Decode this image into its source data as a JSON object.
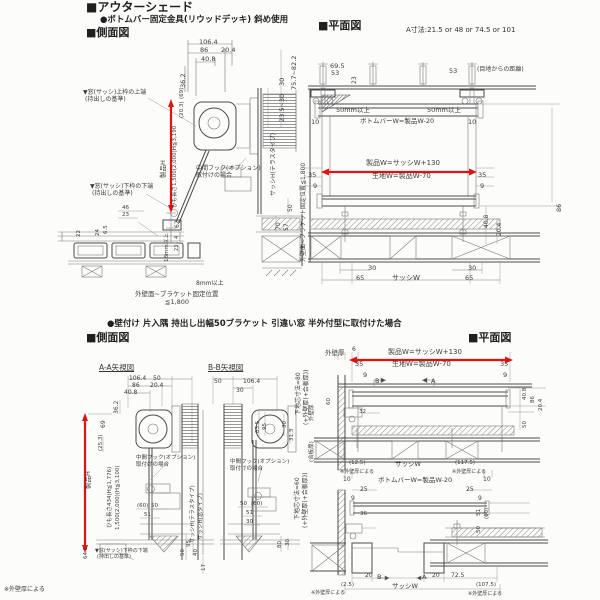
{
  "colors": {
    "accent_red": "#e01212",
    "line": "#7a7a7a",
    "dark_line": "#4c4c4c",
    "text": "#3b3b3b",
    "paper": "#fcfcfb"
  },
  "headers": {
    "title": "■アウターシェード",
    "subtitle": "●ボトムバー固定金具(リウッドデッキ) 斜め使用",
    "side_view_1": "■側面図",
    "plan_view_1": "■平面図",
    "a_dim_note": "A寸法:21.5 or 48 or 74.5 or 101",
    "subtitle_2": "●壁付け 片入隅 持出し出幅50ブラケット 引違い窓 半外付型に取付けた場合",
    "side_view_2": "■側面図",
    "plan_view_2": "■平面図",
    "aa_view": "A-A矢視図",
    "bb_view": "B-B矢視図"
  },
  "labels": [
    {
      "t": "106.4",
      "x": 199,
      "y": 39
    },
    {
      "t": "86",
      "x": 200,
      "y": 47
    },
    {
      "t": "20.4",
      "x": 221,
      "y": 47
    },
    {
      "t": "40.8",
      "x": 201,
      "y": 56
    },
    {
      "t": "36.2",
      "x": 180,
      "y": 88,
      "v": 1
    },
    {
      "t": "75.7~82.2",
      "x": 291,
      "y": 90,
      "v": 1
    },
    {
      "t": "30",
      "x": 279,
      "y": 86,
      "v": 1
    },
    {
      "t": "23.5~30",
      "x": 279,
      "y": 122,
      "v": 1
    },
    {
      "t": "サッシH(テラスタイプ)",
      "x": 271,
      "y": 196,
      "v": 1,
      "fs": 6
    },
    {
      "t": "50",
      "x": 288,
      "y": 212,
      "v": 1,
      "fs": 6
    },
    {
      "t": "70",
      "x": 276,
      "y": 230,
      "v": 1,
      "fs": 6
    },
    {
      "t": "57",
      "x": 284,
      "y": 231,
      "v": 1,
      "fs": 6
    },
    {
      "t": "▼窓(サッシ)上枠の上端",
      "x": 83,
      "y": 90,
      "fs": 6,
      "n": "annotation"
    },
    {
      "t": "(持出しの基準)",
      "x": 85,
      "y": 97,
      "fs": 6,
      "n": "annotation"
    },
    {
      "t": "製品H",
      "x": 160,
      "y": 178,
      "v": 1
    },
    {
      "t": "ひも長さ1,500(2,000)H≦3,190",
      "x": 173,
      "y": 208,
      "v": 1,
      "fs": 5.5
    },
    {
      "t": "(20.3)",
      "x": 180,
      "y": 118,
      "v": 1,
      "fs": 5.5
    },
    {
      "t": "(69)",
      "x": 180,
      "y": 99,
      "v": 1,
      "fs": 5.5
    },
    {
      "t": "中間フック(オプション)",
      "x": 196,
      "y": 166,
      "fs": 6,
      "n": "annotation"
    },
    {
      "t": "取付けの場合",
      "x": 196,
      "y": 173,
      "fs": 6,
      "n": "annotation"
    },
    {
      "t": "▼窓(サッシ)下枠の下端",
      "x": 90,
      "y": 184,
      "fs": 6,
      "n": "annotation"
    },
    {
      "t": "(持出しの基準)",
      "x": 92,
      "y": 191,
      "fs": 6,
      "n": "annotation"
    },
    {
      "t": "46",
      "x": 122,
      "y": 206,
      "fs": 5.5
    },
    {
      "t": "23",
      "x": 122,
      "y": 213,
      "fs": 5.5
    },
    {
      "t": "24",
      "x": 96,
      "y": 236,
      "v": 1,
      "fs": 5.5
    },
    {
      "t": "6.5",
      "x": 104,
      "y": 234,
      "v": 1,
      "fs": 5.5
    },
    {
      "t": "22",
      "x": 77,
      "y": 237,
      "v": 1,
      "fs": 5.5
    },
    {
      "t": "62",
      "x": 175,
      "y": 228,
      "v": 1,
      "fs": 6
    },
    {
      "t": "4",
      "x": 175,
      "y": 239,
      "v": 1,
      "fs": 5
    },
    {
      "t": "23",
      "x": 175,
      "y": 251,
      "v": 1,
      "fs": 5
    },
    {
      "t": "18mm以上",
      "x": 165,
      "y": 262,
      "v": 1,
      "fs": 5.5
    },
    {
      "t": "8mm以上",
      "x": 196,
      "y": 281,
      "fs": 6
    },
    {
      "t": "外壁面~ブラケット固定位置",
      "x": 135,
      "y": 291,
      "fs": 6.5,
      "n": "annotation"
    },
    {
      "t": "≦1,800",
      "x": 165,
      "y": 299,
      "fs": 6.5,
      "n": "annotation"
    },
    {
      "t": "69.5",
      "x": 330,
      "y": 63
    },
    {
      "t": "53",
      "x": 331,
      "y": 70
    },
    {
      "t": "23",
      "x": 352,
      "y": 84,
      "v": 1,
      "fs": 6
    },
    {
      "t": "53",
      "x": 449,
      "y": 68
    },
    {
      "t": "(目地からの距離)",
      "x": 477,
      "y": 67,
      "fs": 6,
      "n": "annotation"
    },
    {
      "t": "外壁面~ブラケット固定位置≦1,800",
      "x": 301,
      "y": 262,
      "v": 1,
      "fs": 6,
      "n": "annotation"
    },
    {
      "t": "50mm以上",
      "x": 336,
      "y": 107
    },
    {
      "t": "50mm以上",
      "x": 427,
      "y": 107
    },
    {
      "t": "10",
      "x": 311,
      "y": 119
    },
    {
      "t": "ボトムバーW=製品W-20",
      "x": 360,
      "y": 118
    },
    {
      "t": "10",
      "x": 468,
      "y": 119
    },
    {
      "t": "製品W=サッシW+130",
      "x": 366,
      "y": 160,
      "fs": 7
    },
    {
      "t": "生地W=製品W-70",
      "x": 372,
      "y": 173,
      "fs": 7
    },
    {
      "t": "35",
      "x": 308,
      "y": 172
    },
    {
      "t": "35",
      "x": 478,
      "y": 172
    },
    {
      "t": "9",
      "x": 313,
      "y": 183
    },
    {
      "t": "9",
      "x": 480,
      "y": 183
    },
    {
      "t": "86",
      "x": 556,
      "y": 212,
      "v": 1
    },
    {
      "t": "40.8",
      "x": 484,
      "y": 228,
      "v": 1,
      "fs": 6
    },
    {
      "t": "20.4",
      "x": 497,
      "y": 236,
      "v": 1,
      "fs": 6
    },
    {
      "t": "30",
      "x": 368,
      "y": 265
    },
    {
      "t": "30",
      "x": 468,
      "y": 265
    },
    {
      "t": "65",
      "x": 356,
      "y": 275
    },
    {
      "t": "サッシW",
      "x": 392,
      "y": 275,
      "fs": 7
    },
    {
      "t": "65",
      "x": 465,
      "y": 275
    },
    {
      "t": "106.4",
      "x": 129,
      "y": 376,
      "fs": 6
    },
    {
      "t": "50",
      "x": 153,
      "y": 376,
      "fs": 6
    },
    {
      "t": "86",
      "x": 132,
      "y": 383,
      "fs": 6
    },
    {
      "t": "20.4",
      "x": 150,
      "y": 383,
      "fs": 6
    },
    {
      "t": "40.8",
      "x": 124,
      "y": 390,
      "fs": 6
    },
    {
      "t": "36.2",
      "x": 114,
      "y": 414,
      "v": 1,
      "fs": 6
    },
    {
      "t": "69",
      "x": 101,
      "y": 428,
      "v": 1,
      "fs": 6
    },
    {
      "t": "50",
      "x": 214,
      "y": 379,
      "fs": 6
    },
    {
      "t": "106.4",
      "x": 243,
      "y": 379,
      "fs": 6
    },
    {
      "t": "30",
      "x": 236,
      "y": 388,
      "fs": 6
    },
    {
      "t": "83.5",
      "x": 256,
      "y": 433,
      "v": 1,
      "fs": 5.5
    },
    {
      "t": "95",
      "x": 263,
      "y": 430,
      "v": 1,
      "fs": 5.5
    },
    {
      "t": "30",
      "x": 283,
      "y": 428,
      "v": 1,
      "fs": 5.5
    },
    {
      "t": "31.3",
      "x": 290,
      "y": 441,
      "v": 1,
      "fs": 5.5
    },
    {
      "t": "(25.3)",
      "x": 99,
      "y": 451,
      "v": 1,
      "fs": 5.5
    },
    {
      "t": "製品H",
      "x": 85,
      "y": 489,
      "v": 1
    },
    {
      "t": "ひも長さ434(H≦1,776)",
      "x": 108,
      "y": 528,
      "v": 1,
      "fs": 5.5
    },
    {
      "t": "1,500(2,000)(H≦3,100)",
      "x": 116,
      "y": 530,
      "v": 1,
      "fs": 5.5
    },
    {
      "t": "中間フック(オプション)",
      "x": 136,
      "y": 456,
      "fs": 5.5,
      "n": "annotation"
    },
    {
      "t": "取付けの場合",
      "x": 136,
      "y": 463,
      "fs": 5.5,
      "n": "annotation"
    },
    {
      "t": "中間フック(オプション)",
      "x": 230,
      "y": 460,
      "fs": 5.5,
      "n": "annotation"
    },
    {
      "t": "取付けの場合",
      "x": 230,
      "y": 467,
      "fs": 5.5,
      "n": "annotation"
    },
    {
      "t": "サッシH(テラスタイプ)",
      "x": 191,
      "y": 543,
      "v": 1,
      "fs": 5.5
    },
    {
      "t": "サッシH(窓タイプ)",
      "x": 199,
      "y": 540,
      "v": 1,
      "fs": 5.5
    },
    {
      "t": "(60)",
      "x": 137,
      "y": 504,
      "fs": 5.5
    },
    {
      "t": "50",
      "x": 151,
      "y": 504,
      "fs": 5.5
    },
    {
      "t": "51",
      "x": 144,
      "y": 513,
      "fs": 5.5
    },
    {
      "t": "50",
      "x": 240,
      "y": 502,
      "fs": 5.5
    },
    {
      "t": "(60)",
      "x": 251,
      "y": 502,
      "fs": 5.5
    },
    {
      "t": "51",
      "x": 246,
      "y": 511,
      "fs": 5.5
    },
    {
      "t": "30",
      "x": 246,
      "y": 520,
      "fs": 5.5
    },
    {
      "t": "95",
      "x": 187,
      "y": 547,
      "v": 1,
      "fs": 5.5
    },
    {
      "t": "50",
      "x": 181,
      "y": 556,
      "v": 1,
      "fs": 5.5
    },
    {
      "t": "40",
      "x": 194,
      "y": 556,
      "v": 1,
      "fs": 5.5
    },
    {
      "t": "17",
      "x": 202,
      "y": 571,
      "v": 1,
      "fs": 5.5
    },
    {
      "t": "80",
      "x": 278,
      "y": 548,
      "v": 1,
      "fs": 5.5
    },
    {
      "t": "30",
      "x": 286,
      "y": 546,
      "v": 1,
      "fs": 5.5
    },
    {
      "t": "64.5",
      "x": 84,
      "y": 559,
      "v": 1,
      "fs": 5.5
    },
    {
      "t": "▼窓(サッシ)下枠の下端",
      "x": 95,
      "y": 549,
      "fs": 5,
      "n": "annotation"
    },
    {
      "t": "(持出しの基準)",
      "x": 97,
      "y": 555,
      "fs": 5,
      "n": "annotation"
    },
    {
      "t": "下地芯寸法=80",
      "x": 296,
      "y": 415,
      "v": 1,
      "fs": 6
    },
    {
      "t": "(+外壁厚(+合板厚))",
      "x": 304,
      "y": 425,
      "v": 1,
      "fs": 6
    },
    {
      "t": "下地芯寸法=60",
      "x": 295,
      "y": 520,
      "v": 1,
      "fs": 6
    },
    {
      "t": "(+外壁厚(+合板厚))",
      "x": 303,
      "y": 528,
      "v": 1,
      "fs": 6
    },
    {
      "t": "外壁厚",
      "x": 325,
      "y": 350
    },
    {
      "t": "6",
      "x": 352,
      "y": 347,
      "fs": 6
    },
    {
      "t": "製品W=サッシW+130",
      "x": 388,
      "y": 349,
      "fs": 7
    },
    {
      "t": "生地W=製品W-70",
      "x": 392,
      "y": 361,
      "fs": 7
    },
    {
      "t": "35",
      "x": 355,
      "y": 361
    },
    {
      "t": "35",
      "x": 500,
      "y": 361
    },
    {
      "t": "9",
      "x": 363,
      "y": 372
    },
    {
      "t": "9",
      "x": 503,
      "y": 372
    },
    {
      "t": "B",
      "x": 375,
      "y": 378
    },
    {
      "t": "A",
      "x": 431,
      "y": 378
    },
    {
      "t": "40.8",
      "x": 523,
      "y": 400,
      "v": 1,
      "fs": 5.5
    },
    {
      "t": "86",
      "x": 531,
      "y": 403,
      "v": 1,
      "fs": 5.5
    },
    {
      "t": "20.4",
      "x": 539,
      "y": 411,
      "v": 1,
      "fs": 5.5
    },
    {
      "t": "50",
      "x": 523,
      "y": 428,
      "v": 1,
      "fs": 5.5
    },
    {
      "t": "60",
      "x": 327,
      "y": 405,
      "v": 1,
      "fs": 5.5
    },
    {
      "t": "32",
      "x": 359,
      "y": 410,
      "fs": 5.5
    },
    {
      "t": "外壁厚",
      "x": 310,
      "y": 421,
      "v": 1,
      "fs": 5.5
    },
    {
      "t": "(合板厚)",
      "x": 310,
      "y": 462,
      "v": 1,
      "fs": 5.5
    },
    {
      "t": "(12.5)",
      "x": 349,
      "y": 461,
      "fs": 5.5
    },
    {
      "t": "サッシW",
      "x": 395,
      "y": 461
    },
    {
      "t": "(117.5)",
      "x": 455,
      "y": 461,
      "fs": 5.5
    },
    {
      "t": "※外壁厚による",
      "x": 340,
      "y": 470,
      "fs": 5,
      "n": "annotation"
    },
    {
      "t": "※外壁厚による",
      "x": 452,
      "y": 470,
      "fs": 5,
      "n": "annotation"
    },
    {
      "t": "10",
      "x": 343,
      "y": 477,
      "fs": 6
    },
    {
      "t": "ボトムバーW=製品W-20",
      "x": 378,
      "y": 477
    },
    {
      "t": "10",
      "x": 483,
      "y": 477,
      "fs": 6
    },
    {
      "t": "25",
      "x": 360,
      "y": 487,
      "fs": 6
    },
    {
      "t": "25",
      "x": 466,
      "y": 487,
      "fs": 6
    },
    {
      "t": "9",
      "x": 351,
      "y": 496,
      "fs": 6
    },
    {
      "t": "9",
      "x": 478,
      "y": 496,
      "fs": 6
    },
    {
      "t": "51",
      "x": 477,
      "y": 516,
      "v": 1,
      "fs": 5.5
    },
    {
      "t": "(60)",
      "x": 485,
      "y": 519,
      "v": 1,
      "fs": 5.5
    },
    {
      "t": "50",
      "x": 477,
      "y": 533,
      "v": 1,
      "fs": 5.5
    },
    {
      "t": "36",
      "x": 360,
      "y": 512,
      "fs": 5.5
    },
    {
      "t": "20",
      "x": 365,
      "y": 573,
      "fs": 6
    },
    {
      "t": "B",
      "x": 377,
      "y": 574
    },
    {
      "t": "A",
      "x": 422,
      "y": 574
    },
    {
      "t": "20",
      "x": 432,
      "y": 573,
      "fs": 6
    },
    {
      "t": "72.5",
      "x": 451,
      "y": 573,
      "fs": 6
    },
    {
      "t": "(2.5)",
      "x": 341,
      "y": 583,
      "fs": 5.5
    },
    {
      "t": "サッシW",
      "x": 392,
      "y": 583
    },
    {
      "t": "(107.5)",
      "x": 476,
      "y": 583,
      "fs": 5.5
    },
    {
      "t": "※外壁厚による",
      "x": 311,
      "y": 591,
      "fs": 5,
      "n": "annotation"
    },
    {
      "t": "※外壁厚による",
      "x": 468,
      "y": 592,
      "fs": 5,
      "n": "annotation"
    },
    {
      "t": "※外壁厚による",
      "x": 4,
      "y": 587,
      "fs": 6,
      "n": "annotation"
    }
  ]
}
